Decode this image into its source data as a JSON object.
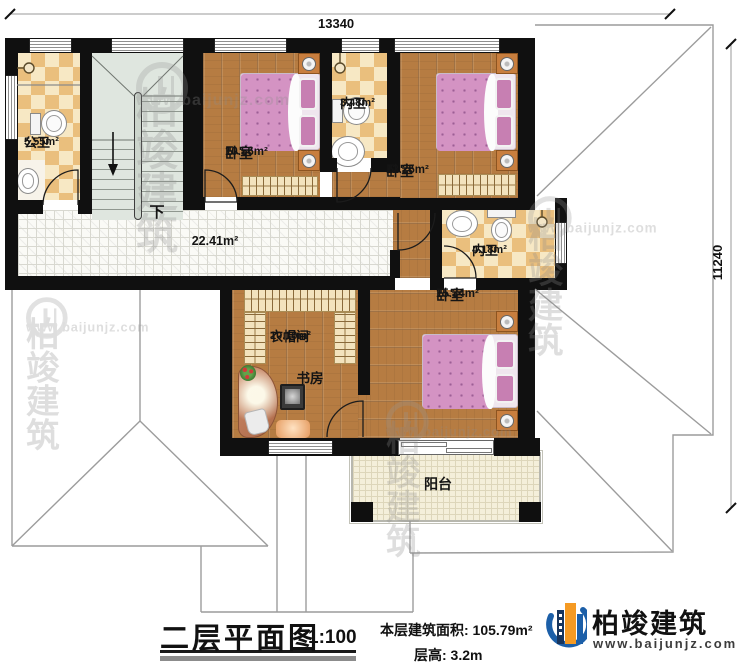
{
  "dimensions": {
    "width_mm": "13340",
    "height_mm": "11240"
  },
  "rooms": {
    "public_bath": {
      "name": "公卫",
      "area": "5.55m²"
    },
    "bedroom_top_left": {
      "name": "卧室",
      "area": "10.56m²"
    },
    "bath_top": {
      "name": "内卫",
      "area": "3.48m²"
    },
    "bedroom_top_right": {
      "name": "卧室",
      "area": "12.25m²"
    },
    "hall": {
      "area": "22.41m²"
    },
    "bath_mid": {
      "name": "内卫",
      "area": "4.18m²"
    },
    "bedroom_master": {
      "name": "卧室",
      "area": "15.34m²"
    },
    "cloakroom": {
      "name": "衣帽间",
      "area": "10.10m²"
    },
    "study": {
      "name": "书房"
    },
    "balcony": {
      "name": "阳台"
    },
    "stairs": {
      "down_label": "下"
    }
  },
  "title_block": {
    "title": "二层平面图",
    "scale": "1:100",
    "floor_area": "本层建筑面积: 105.79m²",
    "floor_height": "层高: 3.2m"
  },
  "brand": {
    "name": "柏竣建筑",
    "url": "www.baijunjz.com"
  },
  "watermark": {
    "name": "柏竣建筑",
    "url": "www.baijunjz.com"
  },
  "colors": {
    "wall": "#101010",
    "wood": "#b67c42",
    "tile_dark": "#eabf7d",
    "tile_light": "#f7e8c4",
    "bed_pink": "#d493c3",
    "brand_blue": "#1c5fa8",
    "brand_orange": "#f59a23"
  }
}
